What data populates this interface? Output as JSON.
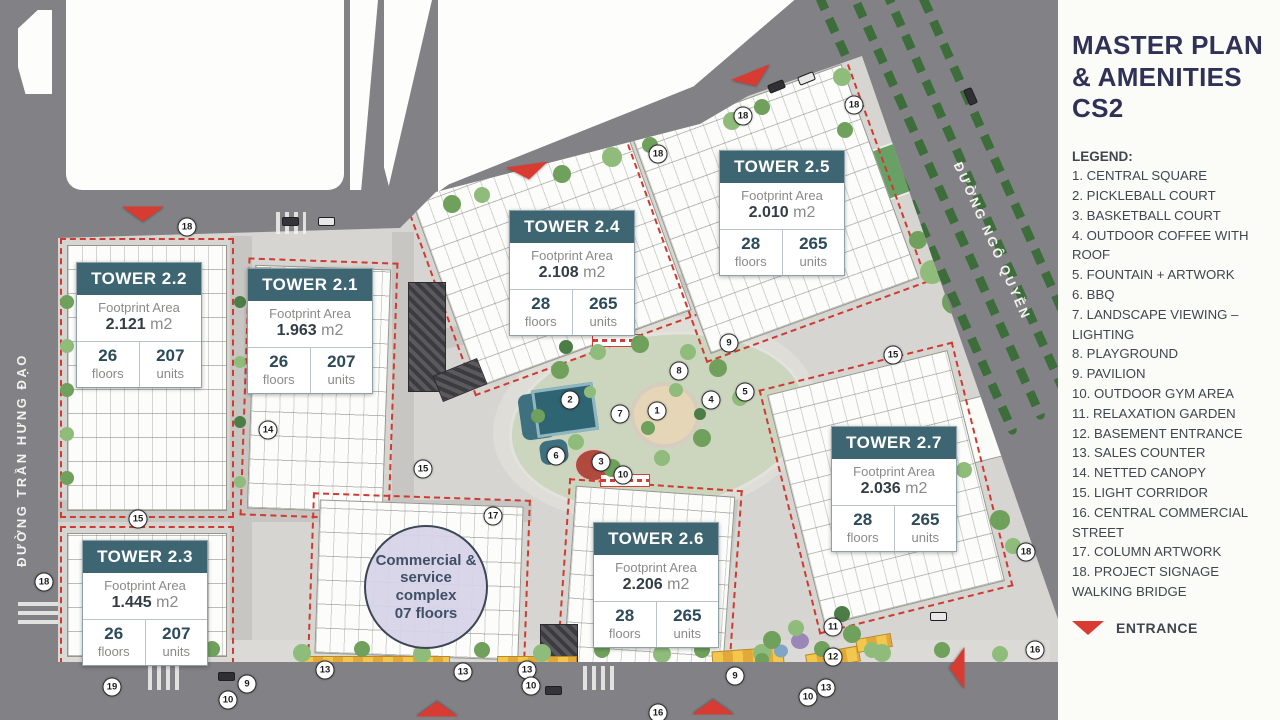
{
  "panel": {
    "title": "MASTER PLAN & AMENITIES CS2",
    "legend_heading": "LEGEND:",
    "legend_items": [
      "1. CENTRAL SQUARE",
      "2. PICKLEBALL COURT",
      "3. BASKETBALL COURT",
      "4. OUTDOOR COFFEE WITH ROOF",
      "5. FOUNTAIN + ARTWORK",
      "6. BBQ",
      "7. LANDSCAPE VIEWING – LIGHTING",
      "8. PLAYGROUND",
      "9. PAVILION",
      "10. OUTDOOR GYM AREA",
      "11. RELAXATION GARDEN",
      "12. BASEMENT ENTRANCE",
      "13. SALES COUNTER",
      "14. NETTED CANOPY",
      "15. LIGHT CORRIDOR",
      "16. CENTRAL COMMERCIAL STREET",
      "17. COLUMN ARTWORK",
      "18. PROJECT SIGNAGE",
      "WALKING BRIDGE"
    ],
    "entrance_label": "ENTRANCE"
  },
  "streets": {
    "left": "ĐƯỜNG TRẦN HƯNG ĐẠO",
    "right": "ĐƯỜNG NGÔ QUYỀN"
  },
  "card_labels": {
    "footprint": "Footprint Area",
    "unit": "m2",
    "floors": "floors",
    "units": "units"
  },
  "towers": [
    {
      "id": "2.1",
      "name": "TOWER 2.1",
      "area": "1.963",
      "floors": "26",
      "units": "207"
    },
    {
      "id": "2.2",
      "name": "TOWER 2.2",
      "area": "2.121",
      "floors": "26",
      "units": "207"
    },
    {
      "id": "2.3",
      "name": "TOWER 2.3",
      "area": "1.445",
      "floors": "26",
      "units": "207"
    },
    {
      "id": "2.4",
      "name": "TOWER 2.4",
      "area": "2.108",
      "floors": "28",
      "units": "265"
    },
    {
      "id": "2.5",
      "name": "TOWER 2.5",
      "area": "2.010",
      "floors": "28",
      "units": "265"
    },
    {
      "id": "2.6",
      "name": "TOWER 2.6",
      "area": "2.206",
      "floors": "28",
      "units": "265"
    },
    {
      "id": "2.7",
      "name": "TOWER 2.7",
      "area": "2.036",
      "floors": "28",
      "units": "265"
    }
  ],
  "commercial": {
    "label": "Commercial & service complex",
    "floors": "07 floors"
  },
  "markers": [
    {
      "n": "18",
      "x": 187,
      "y": 227
    },
    {
      "n": "18",
      "x": 658,
      "y": 154
    },
    {
      "n": "18",
      "x": 743,
      "y": 116
    },
    {
      "n": "18",
      "x": 854,
      "y": 105
    },
    {
      "n": "18",
      "x": 1026,
      "y": 552
    },
    {
      "n": "18",
      "x": 44,
      "y": 582
    },
    {
      "n": "15",
      "x": 138,
      "y": 519
    },
    {
      "n": "15",
      "x": 423,
      "y": 469
    },
    {
      "n": "15",
      "x": 893,
      "y": 355
    },
    {
      "n": "14",
      "x": 268,
      "y": 430
    },
    {
      "n": "17",
      "x": 493,
      "y": 516
    },
    {
      "n": "1",
      "x": 657,
      "y": 411
    },
    {
      "n": "2",
      "x": 570,
      "y": 400
    },
    {
      "n": "3",
      "x": 601,
      "y": 462
    },
    {
      "n": "4",
      "x": 711,
      "y": 400
    },
    {
      "n": "5",
      "x": 745,
      "y": 392
    },
    {
      "n": "6",
      "x": 556,
      "y": 456
    },
    {
      "n": "7",
      "x": 620,
      "y": 414
    },
    {
      "n": "8",
      "x": 679,
      "y": 371
    },
    {
      "n": "9",
      "x": 729,
      "y": 343
    },
    {
      "n": "10",
      "x": 623,
      "y": 475
    },
    {
      "n": "13",
      "x": 325,
      "y": 670
    },
    {
      "n": "13",
      "x": 463,
      "y": 672
    },
    {
      "n": "13",
      "x": 527,
      "y": 670
    },
    {
      "n": "10",
      "x": 228,
      "y": 700
    },
    {
      "n": "10",
      "x": 531,
      "y": 686
    },
    {
      "n": "19",
      "x": 112,
      "y": 687
    },
    {
      "n": "9",
      "x": 247,
      "y": 684
    },
    {
      "n": "11",
      "x": 833,
      "y": 627
    },
    {
      "n": "12",
      "x": 833,
      "y": 657
    },
    {
      "n": "13",
      "x": 826,
      "y": 688
    },
    {
      "n": "9",
      "x": 735,
      "y": 676
    },
    {
      "n": "10",
      "x": 808,
      "y": 697
    },
    {
      "n": "16",
      "x": 658,
      "y": 713
    },
    {
      "n": "16",
      "x": 1035,
      "y": 650
    }
  ],
  "colors": {
    "card_header": "#3d6572",
    "title_navy": "#2f3156",
    "entrance_red": "#d83b31",
    "road_gray": "#828286",
    "site_light": "#d6d5d1",
    "commercial_lavender": "#d6d3e8"
  }
}
